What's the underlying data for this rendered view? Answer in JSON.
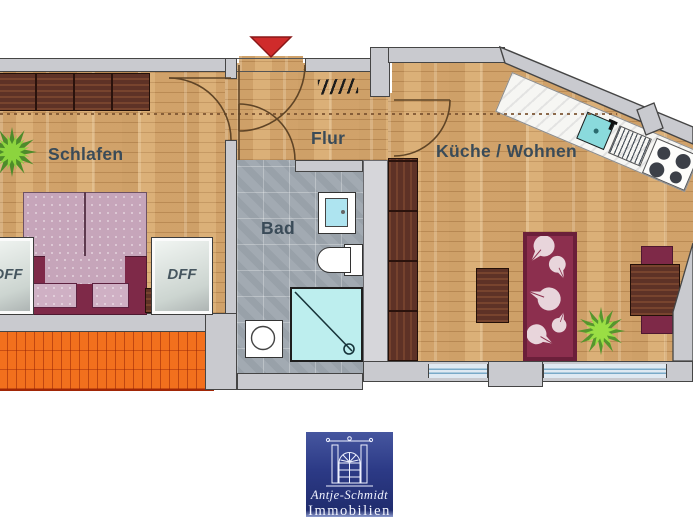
{
  "floorplan": {
    "rooms": {
      "bedroom": "Schlafen",
      "hallway": "Flur",
      "bathroom": "Bad",
      "kitchen_living": "Küche / Wohnen"
    },
    "window_labels": {
      "left": "DFF",
      "right": "DFF"
    },
    "colors": {
      "wood": "#d7ab74",
      "wall": "#c9cacf",
      "tile": "#a2aab2",
      "roof": "#f2701d",
      "arrow": "#cf2b2b",
      "bedframe": "#7e2948",
      "rug": "#8c2f4e",
      "shower": "#bdeeee",
      "sinkteal": "#8adadc",
      "logoblue": "#2c3a86",
      "label": "#3a4b58"
    }
  },
  "logo": {
    "line1": "Antje-Schmidt",
    "line2": "Immobilien"
  }
}
